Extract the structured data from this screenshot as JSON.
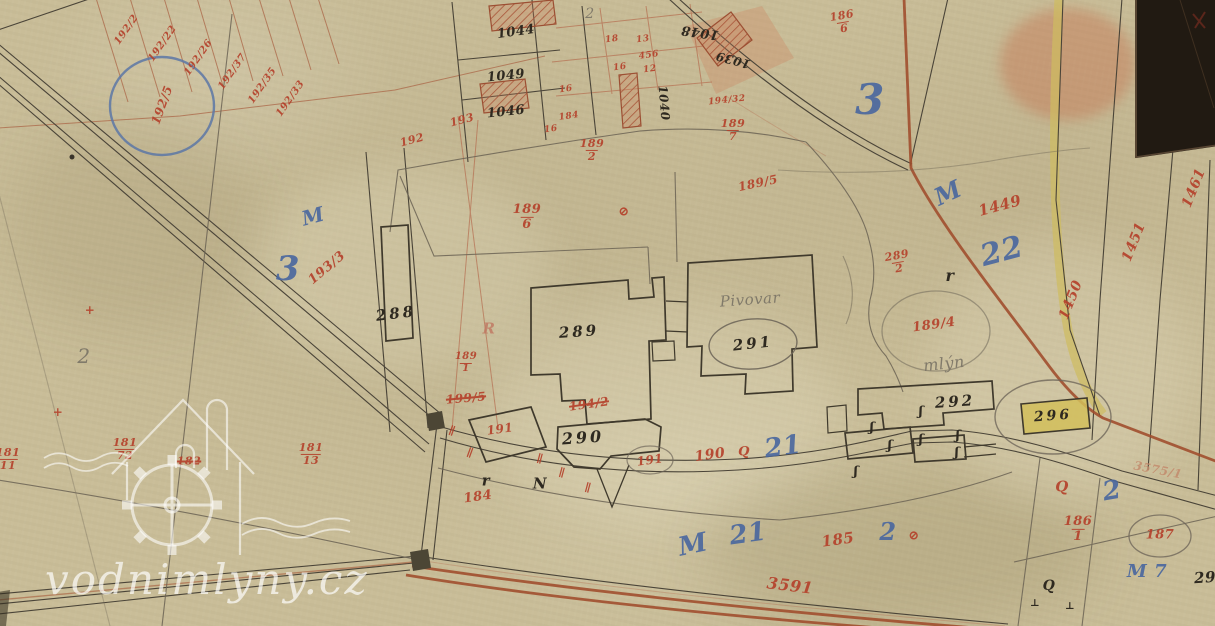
{
  "watermark": {
    "text": "vodnimlyny.cz"
  },
  "colors": {
    "paper": "#c9bd98",
    "red": "#b5422c",
    "black": "#2e2920",
    "blue": "#49679f",
    "pencil": "#7d7668",
    "lightred": "#c07a63",
    "redfaint": "#c2886a",
    "brown_road": "#a14f2e",
    "yellow_road": "#cfbc5f"
  },
  "labels": [
    {
      "t": "192/2",
      "x": 127,
      "y": 30,
      "r": -55,
      "s": 10,
      "c": "red"
    },
    {
      "t": "192/22",
      "x": 163,
      "y": 44,
      "r": -55,
      "s": 10,
      "c": "red"
    },
    {
      "t": "192/26",
      "x": 199,
      "y": 58,
      "r": -55,
      "s": 10,
      "c": "red"
    },
    {
      "t": "192/37",
      "x": 233,
      "y": 72,
      "r": -55,
      "s": 10,
      "c": "red"
    },
    {
      "t": "192/35",
      "x": 263,
      "y": 86,
      "r": -55,
      "s": 10,
      "c": "red"
    },
    {
      "t": "192/33",
      "x": 291,
      "y": 99,
      "r": -55,
      "s": 10,
      "c": "red"
    },
    {
      "t": "192/5",
      "x": 162,
      "y": 105,
      "r": -70,
      "s": 12,
      "c": "red"
    },
    {
      "t": "1044",
      "x": 516,
      "y": 32,
      "r": -8,
      "s": 13,
      "c": "black"
    },
    {
      "t": "1049",
      "x": 506,
      "y": 76,
      "r": -6,
      "s": 13,
      "c": "black"
    },
    {
      "t": "1046",
      "x": 506,
      "y": 112,
      "r": -6,
      "s": 13,
      "c": "black"
    },
    {
      "t": "1048",
      "x": 700,
      "y": 32,
      "r": 188,
      "s": 13,
      "c": "black"
    },
    {
      "t": "1039",
      "x": 733,
      "y": 60,
      "r": 195,
      "s": 12,
      "c": "black"
    },
    {
      "t": "1040",
      "x": 664,
      "y": 103,
      "r": 85,
      "s": 12,
      "c": "black"
    },
    {
      "t": "18",
      "x": 612,
      "y": 40,
      "r": -8,
      "s": 9,
      "c": "red"
    },
    {
      "t": "13",
      "x": 643,
      "y": 40,
      "r": -8,
      "s": 9,
      "c": "red"
    },
    {
      "t": "456",
      "x": 649,
      "y": 56,
      "r": -8,
      "s": 9,
      "c": "red"
    },
    {
      "t": "16",
      "x": 620,
      "y": 68,
      "r": -8,
      "s": 9,
      "c": "red"
    },
    {
      "t": "12",
      "x": 650,
      "y": 70,
      "r": -8,
      "s": 9,
      "c": "red"
    },
    {
      "t": "16",
      "x": 566,
      "y": 90,
      "r": -8,
      "s": 9,
      "c": "red"
    },
    {
      "t": "184",
      "x": 569,
      "y": 117,
      "r": -8,
      "s": 9,
      "c": "red"
    },
    {
      "t": "16",
      "x": 551,
      "y": 130,
      "r": -8,
      "s": 9,
      "c": "red"
    },
    {
      "t": "194/32",
      "x": 727,
      "y": 101,
      "r": -6,
      "s": 9,
      "c": "red"
    },
    {
      "t": "193",
      "x": 462,
      "y": 120,
      "r": -15,
      "s": 11,
      "c": "red"
    },
    {
      "t": "192",
      "x": 412,
      "y": 140,
      "r": -15,
      "s": 11,
      "c": "red"
    },
    {
      "n": "189",
      "d": "2",
      "x": 592,
      "y": 150,
      "s": 11,
      "c": "red"
    },
    {
      "n": "189",
      "d": "7",
      "x": 733,
      "y": 130,
      "s": 11,
      "c": "red"
    },
    {
      "t": "189/5",
      "x": 758,
      "y": 183,
      "r": -12,
      "s": 12,
      "c": "red"
    },
    {
      "n": "189",
      "d": "6",
      "x": 527,
      "y": 217,
      "s": 13,
      "c": "red"
    },
    {
      "t": "⊘",
      "x": 624,
      "y": 212,
      "s": 13,
      "c": "red"
    },
    {
      "n": "186",
      "d": "6",
      "x": 843,
      "y": 22,
      "r": -10,
      "s": 11,
      "c": "red"
    },
    {
      "t": "3",
      "x": 870,
      "y": 100,
      "s": 42,
      "c": "blue"
    },
    {
      "t": "M",
      "x": 948,
      "y": 193,
      "r": -25,
      "s": 24,
      "c": "blue"
    },
    {
      "t": "1449",
      "x": 1000,
      "y": 206,
      "r": -15,
      "s": 15,
      "c": "red"
    },
    {
      "t": "22",
      "x": 1002,
      "y": 252,
      "r": -15,
      "s": 30,
      "c": "blue"
    },
    {
      "t": "1450",
      "x": 1071,
      "y": 300,
      "r": -68,
      "s": 14,
      "c": "red"
    },
    {
      "t": "1451",
      "x": 1134,
      "y": 242,
      "r": -68,
      "s": 14,
      "c": "red"
    },
    {
      "t": "1461",
      "x": 1194,
      "y": 188,
      "r": -68,
      "s": 14,
      "c": "red"
    },
    {
      "n": "289",
      "d": "2",
      "x": 898,
      "y": 262,
      "r": -10,
      "s": 11,
      "c": "red"
    },
    {
      "t": "r",
      "x": 950,
      "y": 276,
      "s": 16,
      "c": "black"
    },
    {
      "t": "189/4",
      "x": 934,
      "y": 325,
      "r": -8,
      "s": 13,
      "c": "red"
    },
    {
      "t": "mlýn",
      "x": 944,
      "y": 364,
      "r": -6,
      "s": 16,
      "c": "pencil"
    },
    {
      "t": "3",
      "x": 288,
      "y": 269,
      "s": 34,
      "c": "blue"
    },
    {
      "t": "M",
      "x": 313,
      "y": 216,
      "r": -15,
      "s": 20,
      "c": "blue"
    },
    {
      "t": "193/3",
      "x": 327,
      "y": 268,
      "r": -40,
      "s": 13,
      "c": "red"
    },
    {
      "t": "288",
      "x": 396,
      "y": 314,
      "r": -7,
      "s": 15,
      "c": "black sp"
    },
    {
      "t": "R",
      "x": 489,
      "y": 329,
      "s": 15,
      "c": "lightred"
    },
    {
      "t": "289",
      "x": 579,
      "y": 332,
      "r": -4,
      "s": 15,
      "c": "black sp"
    },
    {
      "t": "Pivovar",
      "x": 750,
      "y": 300,
      "r": -4,
      "s": 15,
      "c": "pencil"
    },
    {
      "t": "291",
      "x": 753,
      "y": 344,
      "r": -6,
      "s": 15,
      "c": "black sp"
    },
    {
      "t": "292",
      "x": 955,
      "y": 402,
      "r": -4,
      "s": 15,
      "c": "black sp"
    },
    {
      "t": "296",
      "x": 1053,
      "y": 416,
      "r": -4,
      "s": 14,
      "c": "black sp"
    },
    {
      "n": "189",
      "d": "1",
      "x": 466,
      "y": 363,
      "s": 10,
      "c": "red"
    },
    {
      "t": "199/5",
      "x": 466,
      "y": 398,
      "r": -5,
      "s": 12,
      "c": "red strike"
    },
    {
      "t": "194/2",
      "x": 589,
      "y": 404,
      "r": -8,
      "s": 12,
      "c": "red strike"
    },
    {
      "t": "191",
      "x": 500,
      "y": 429,
      "r": -8,
      "s": 12,
      "c": "red"
    },
    {
      "t": "290",
      "x": 583,
      "y": 438,
      "r": -4,
      "s": 16,
      "c": "black sp"
    },
    {
      "t": "191",
      "x": 650,
      "y": 460,
      "r": -8,
      "s": 12,
      "c": "red"
    },
    {
      "t": "190",
      "x": 710,
      "y": 455,
      "r": -8,
      "s": 14,
      "c": "red"
    },
    {
      "t": "Q",
      "x": 744,
      "y": 452,
      "s": 13,
      "c": "red"
    },
    {
      "t": "21",
      "x": 783,
      "y": 447,
      "r": -8,
      "s": 26,
      "c": "blue"
    },
    {
      "t": "r",
      "x": 486,
      "y": 481,
      "s": 15,
      "c": "black"
    },
    {
      "t": "N",
      "x": 540,
      "y": 484,
      "s": 15,
      "c": "black"
    },
    {
      "t": "184",
      "x": 478,
      "y": 497,
      "r": -8,
      "s": 13,
      "c": "red"
    },
    {
      "t": "185",
      "x": 838,
      "y": 540,
      "r": -8,
      "s": 15,
      "c": "red"
    },
    {
      "t": "2",
      "x": 888,
      "y": 532,
      "s": 24,
      "c": "blue"
    },
    {
      "t": "⊘",
      "x": 914,
      "y": 536,
      "s": 13,
      "c": "red"
    },
    {
      "t": "M",
      "x": 693,
      "y": 545,
      "r": -12,
      "s": 26,
      "c": "blue"
    },
    {
      "t": "21",
      "x": 748,
      "y": 534,
      "r": -8,
      "s": 26,
      "c": "blue"
    },
    {
      "t": "3591",
      "x": 790,
      "y": 586,
      "r": 7,
      "s": 16,
      "c": "red"
    },
    {
      "t": "Q",
      "x": 1062,
      "y": 487,
      "s": 15,
      "c": "red"
    },
    {
      "t": "2",
      "x": 1112,
      "y": 491,
      "r": -10,
      "s": 26,
      "c": "blue"
    },
    {
      "n": "186",
      "d": "1",
      "x": 1078,
      "y": 529,
      "s": 13,
      "c": "red"
    },
    {
      "t": "187",
      "x": 1160,
      "y": 535,
      "s": 13,
      "c": "red"
    },
    {
      "t": "M 7",
      "x": 1147,
      "y": 572,
      "s": 18,
      "c": "blue"
    },
    {
      "t": "29",
      "x": 1205,
      "y": 578,
      "r": -4,
      "s": 15,
      "c": "black"
    },
    {
      "t": "Q",
      "x": 1049,
      "y": 586,
      "s": 14,
      "c": "black"
    },
    {
      "t": "3575/1",
      "x": 1158,
      "y": 470,
      "r": 11,
      "s": 12,
      "c": "redfaint"
    },
    {
      "n": "181",
      "d": "72",
      "x": 125,
      "y": 449,
      "s": 11,
      "c": "red"
    },
    {
      "t": "182",
      "x": 189,
      "y": 461,
      "s": 11,
      "c": "red strike"
    },
    {
      "n": "181",
      "d": "13",
      "x": 311,
      "y": 454,
      "s": 11,
      "c": "red"
    },
    {
      "n": "181",
      "d": "11",
      "x": 8,
      "y": 459,
      "s": 11,
      "c": "red"
    },
    {
      "t": "2",
      "x": 84,
      "y": 356,
      "s": 20,
      "c": "pencil"
    },
    {
      "t": "2",
      "x": 590,
      "y": 14,
      "s": 14,
      "c": "pencil"
    },
    {
      "t": "+",
      "x": 90,
      "y": 310,
      "s": 12,
      "c": "red"
    },
    {
      "t": "+",
      "x": 58,
      "y": 412,
      "s": 12,
      "c": "red"
    },
    {
      "t": "∥",
      "x": 452,
      "y": 431,
      "r": 20,
      "s": 11,
      "c": "red"
    },
    {
      "t": "∥",
      "x": 470,
      "y": 453,
      "r": 20,
      "s": 11,
      "c": "red"
    },
    {
      "t": "∥",
      "x": 540,
      "y": 459,
      "r": 15,
      "s": 11,
      "c": "red"
    },
    {
      "t": "∥",
      "x": 562,
      "y": 473,
      "r": 15,
      "s": 11,
      "c": "red"
    },
    {
      "t": "∥",
      "x": 588,
      "y": 488,
      "r": 15,
      "s": 11,
      "c": "red"
    },
    {
      "t": "ʃ",
      "x": 872,
      "y": 428,
      "s": 13,
      "c": "black"
    },
    {
      "t": "ʃ",
      "x": 890,
      "y": 446,
      "s": 13,
      "c": "black"
    },
    {
      "t": "ʃ",
      "x": 921,
      "y": 412,
      "s": 13,
      "c": "black"
    },
    {
      "t": "ʃ",
      "x": 921,
      "y": 440,
      "s": 13,
      "c": "black"
    },
    {
      "t": "ʃ",
      "x": 856,
      "y": 472,
      "s": 13,
      "c": "black"
    },
    {
      "t": "ʃ",
      "x": 958,
      "y": 436,
      "s": 13,
      "c": "black"
    },
    {
      "t": "ʃ",
      "x": 957,
      "y": 453,
      "s": 13,
      "c": "black"
    },
    {
      "t": "⊥",
      "x": 1035,
      "y": 604,
      "s": 10,
      "c": "black"
    },
    {
      "t": "⊥",
      "x": 1070,
      "y": 607,
      "s": 10,
      "c": "black"
    }
  ]
}
